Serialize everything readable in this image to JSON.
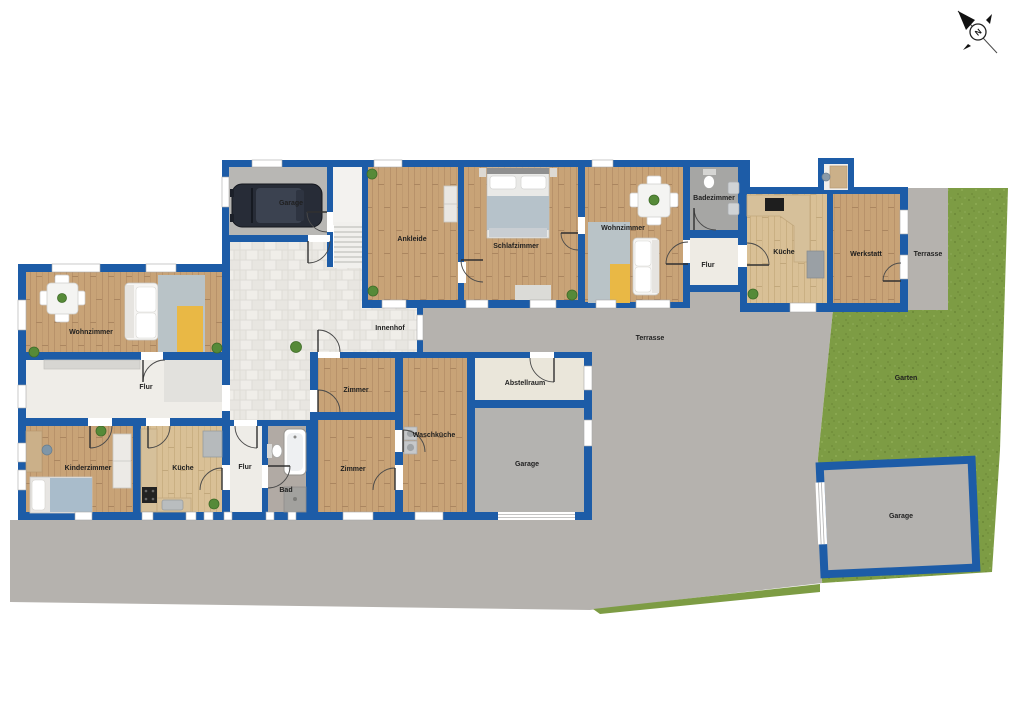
{
  "plan": {
    "compass_label": "N",
    "colors": {
      "wall": "#1d5ca7",
      "wood_floor": "#c8a377",
      "wood_floor_light": "#d9c096",
      "terrace_gray": "#b5b2ae",
      "garden_green": "#7d9c44",
      "courtyard_tile": "#eceae5",
      "rug_blue": "#b9c3c7",
      "rug_yellow": "#e9b845"
    },
    "rooms": {
      "garage_top": {
        "label": "Garage"
      },
      "ankleide": {
        "label": "Ankleide"
      },
      "schlafzimmer": {
        "label": "Schlafzimmer"
      },
      "wohnzimmer_top": {
        "label": "Wohnzimmer"
      },
      "badezimmer": {
        "label": "Badezimmer"
      },
      "flur_top": {
        "label": "Flur"
      },
      "kueche_top": {
        "label": "Küche"
      },
      "werkstatt": {
        "label": "Werkstatt"
      },
      "terrasse_side": {
        "label": "Terrasse"
      },
      "wohnzimmer_left": {
        "label": "Wohnzimmer"
      },
      "flur_left": {
        "label": "Flur"
      },
      "kinderzimmer": {
        "label": "Kinderzimmer"
      },
      "kueche_left": {
        "label": "Küche"
      },
      "flur_small": {
        "label": "Flur"
      },
      "bad": {
        "label": "Bad"
      },
      "zimmer_upper": {
        "label": "Zimmer"
      },
      "zimmer_lower": {
        "label": "Zimmer"
      },
      "waschkueche": {
        "label": "Waschküche"
      },
      "abstellraum": {
        "label": "Abstellraum"
      },
      "garage_middle": {
        "label": "Garage"
      },
      "innenhof": {
        "label": "Innenhof"
      },
      "terrasse_main": {
        "label": "Terrasse"
      },
      "garten": {
        "label": "Garten"
      },
      "garage_outdoor": {
        "label": "Garage"
      }
    }
  }
}
